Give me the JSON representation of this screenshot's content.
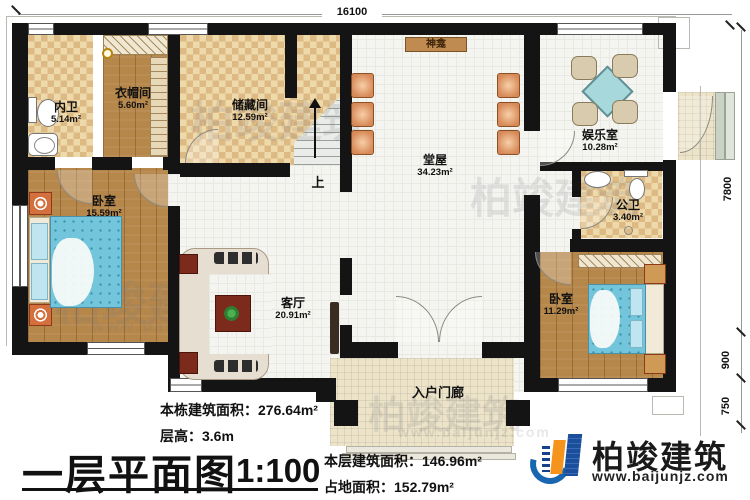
{
  "dimensions": {
    "top": "16100",
    "right_upper": "7800",
    "right_mid": "900",
    "right_lower": "750"
  },
  "rooms": {
    "neiwei": {
      "name": "内卫",
      "area": "5.14m²"
    },
    "yimaojian": {
      "name": "衣帽间",
      "area": "5.60m²"
    },
    "chucangjian": {
      "name": "储藏间",
      "area": "12.59m²"
    },
    "tangwu": {
      "name": "堂屋",
      "area": "34.23m²"
    },
    "yuleshi": {
      "name": "娱乐室",
      "area": "10.28m²"
    },
    "gongwei": {
      "name": "公卫",
      "area": "3.40m²"
    },
    "bedroom_left": {
      "name": "卧室",
      "area": "15.59m²"
    },
    "keting": {
      "name": "客厅",
      "area": "20.91m²"
    },
    "bedroom_right": {
      "name": "卧室",
      "area": "11.29m²"
    },
    "porch": {
      "name": "入户门廊"
    }
  },
  "annotations": {
    "shrine": "神龛",
    "stairs_up": "上"
  },
  "title_block": {
    "building_area_label": "本栋建筑面积：",
    "building_area_value": "276.64m²",
    "floor_height_label": "层高：",
    "floor_height_value": "3.6m",
    "plan_title": "一层平面图",
    "scale": "1:100",
    "floor_area_label": "本层建筑面积：",
    "floor_area_value": "146.96m²",
    "footprint_label": "占地面积：",
    "footprint_value": "152.79m²"
  },
  "brand": {
    "name": "柏竣建筑",
    "website": "www.baijunjz.com"
  },
  "watermark": {
    "text": "柏竣建筑",
    "url": "www.baijunjz.com"
  },
  "colors": {
    "wall": "#141414",
    "wood_floor": "#b6874b",
    "tile_floor": "#f4f4f1",
    "checker_light": "#eed9ab",
    "checker_dark": "#ddba84",
    "mattress": "#72c5da",
    "chair": "#d78a58",
    "brand_blue": "#1b4e9b",
    "brand_orange": "#f5941d"
  }
}
